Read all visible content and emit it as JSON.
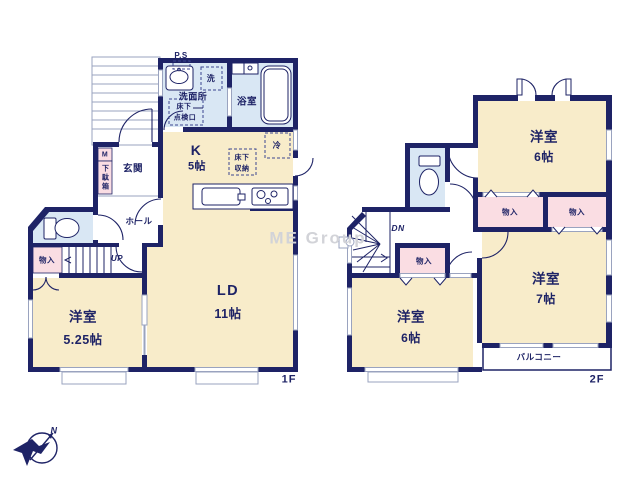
{
  "watermark": "ME Group",
  "compass": {
    "north": "N"
  },
  "colors": {
    "wall_navy": "#1e2366",
    "room_cream": "#f8ecca",
    "wet_blue": "#d9e7f4",
    "closet_pink": "#fadde3",
    "window_gray": "#9aa3bf",
    "watermark_gray": "#d2d3d8"
  },
  "f1": {
    "floor_label": "1F",
    "ps": "P.S",
    "laundry": "洗",
    "washroom": "洗面所",
    "hatch_line1": "床下",
    "hatch_line2": "点検口",
    "bathroom": "浴室",
    "meter": "M",
    "shoe_box": "下駄箱",
    "entrance": "玄関",
    "hall": "ホール",
    "kitchen": "K",
    "kitchen_size": "5帖",
    "fridge": "冷",
    "underfloor_line1": "床下",
    "underfloor_line2": "収納",
    "closet": "物入",
    "up": "UP",
    "west_room": "洋室",
    "west_room_size": "5.25帖",
    "living": "LD",
    "living_size": "11帖"
  },
  "f2": {
    "floor_label": "2F",
    "dn": "DN",
    "closet_a": "物入",
    "closet_b": "物入",
    "closet_c": "物入",
    "room_top": "洋室",
    "room_top_size": "6帖",
    "room_right": "洋室",
    "room_right_size": "7帖",
    "room_left": "洋室",
    "room_left_size": "6帖",
    "balcony": "バルコニー"
  }
}
